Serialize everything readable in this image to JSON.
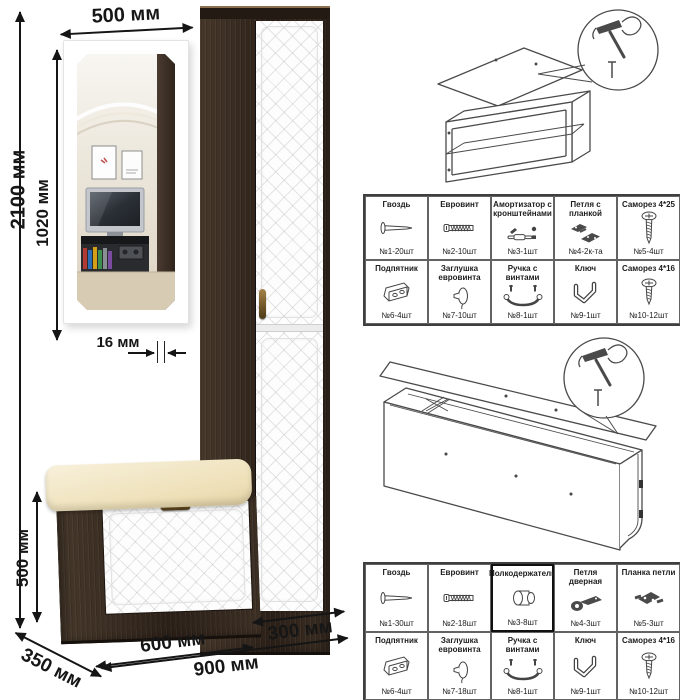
{
  "colors": {
    "wenge": "#382c23",
    "door_white": "#fdfdfd",
    "cushion": "#f0e6c4",
    "bronze_handle": "#8a6a33",
    "dimension_line": "#151515",
    "sketch_line": "#4a4a4a"
  },
  "dimensions": {
    "total_height": "2100 мм",
    "mirror_height": "1020 мм",
    "mirror_width": "500 мм",
    "mirror_thickness": "16 мм",
    "bench_height": "500 мм",
    "bench_depth": "350 мм",
    "bench_width": "600 мм",
    "cabinet_width": "300 мм",
    "total_width": "900 мм"
  },
  "hardware_table_top": {
    "rows": [
      [
        {
          "label": "Гвоздь",
          "qty": "№1-20шт",
          "icon": "nail-icon"
        },
        {
          "label": "Евровинт",
          "qty": "№2-10шт",
          "icon": "euroscrew-icon"
        },
        {
          "label": "Амортизатор с кронштейнами",
          "qty": "№3-1шт",
          "icon": "gas-lift-icon"
        },
        {
          "label": "Петля с планкой",
          "qty": "№4-2к-та",
          "icon": "hinge-with-plate-icon"
        },
        {
          "label": "Саморез 4*25",
          "qty": "№5-4шт",
          "icon": "screw-long-icon"
        }
      ],
      [
        {
          "label": "Подпятник",
          "qty": "№6-4шт",
          "icon": "foot-glide-icon"
        },
        {
          "label": "Заглушка евровинта",
          "qty": "№7-10шт",
          "icon": "cover-cap-icon"
        },
        {
          "label": "Ручка с винтами",
          "qty": "№8-1шт",
          "icon": "handle-icon"
        },
        {
          "label": "Ключ",
          "qty": "№9-1шт",
          "icon": "hex-key-icon"
        },
        {
          "label": "Саморез 4*16",
          "qty": "№10-12шт",
          "icon": "screw-short-icon"
        }
      ]
    ]
  },
  "hardware_table_bottom": {
    "rows": [
      [
        {
          "label": "Гвоздь",
          "qty": "№1-30шт",
          "icon": "nail-icon"
        },
        {
          "label": "Евровинт",
          "qty": "№2-18шт",
          "icon": "euroscrew-icon"
        },
        {
          "label": "Полкодержатель",
          "qty": "№3-8шт",
          "icon": "shelf-pin-icon"
        },
        {
          "label": "Петля дверная",
          "qty": "№4-3шт",
          "icon": "door-hinge-icon"
        },
        {
          "label": "Планка петли",
          "qty": "№5-3шт",
          "icon": "hinge-plate-icon"
        }
      ],
      [
        {
          "label": "Подпятник",
          "qty": "№6-4шт",
          "icon": "foot-glide-icon"
        },
        {
          "label": "Заглушка евровинта",
          "qty": "№7-18шт",
          "icon": "cover-cap-icon"
        },
        {
          "label": "Ручка с винтами",
          "qty": "№8-1шт",
          "icon": "handle-icon"
        },
        {
          "label": "Ключ",
          "qty": "№9-1шт",
          "icon": "hex-key-icon"
        },
        {
          "label": "Саморез 4*16",
          "qty": "№10-12шт",
          "icon": "screw-short-icon"
        }
      ]
    ]
  }
}
